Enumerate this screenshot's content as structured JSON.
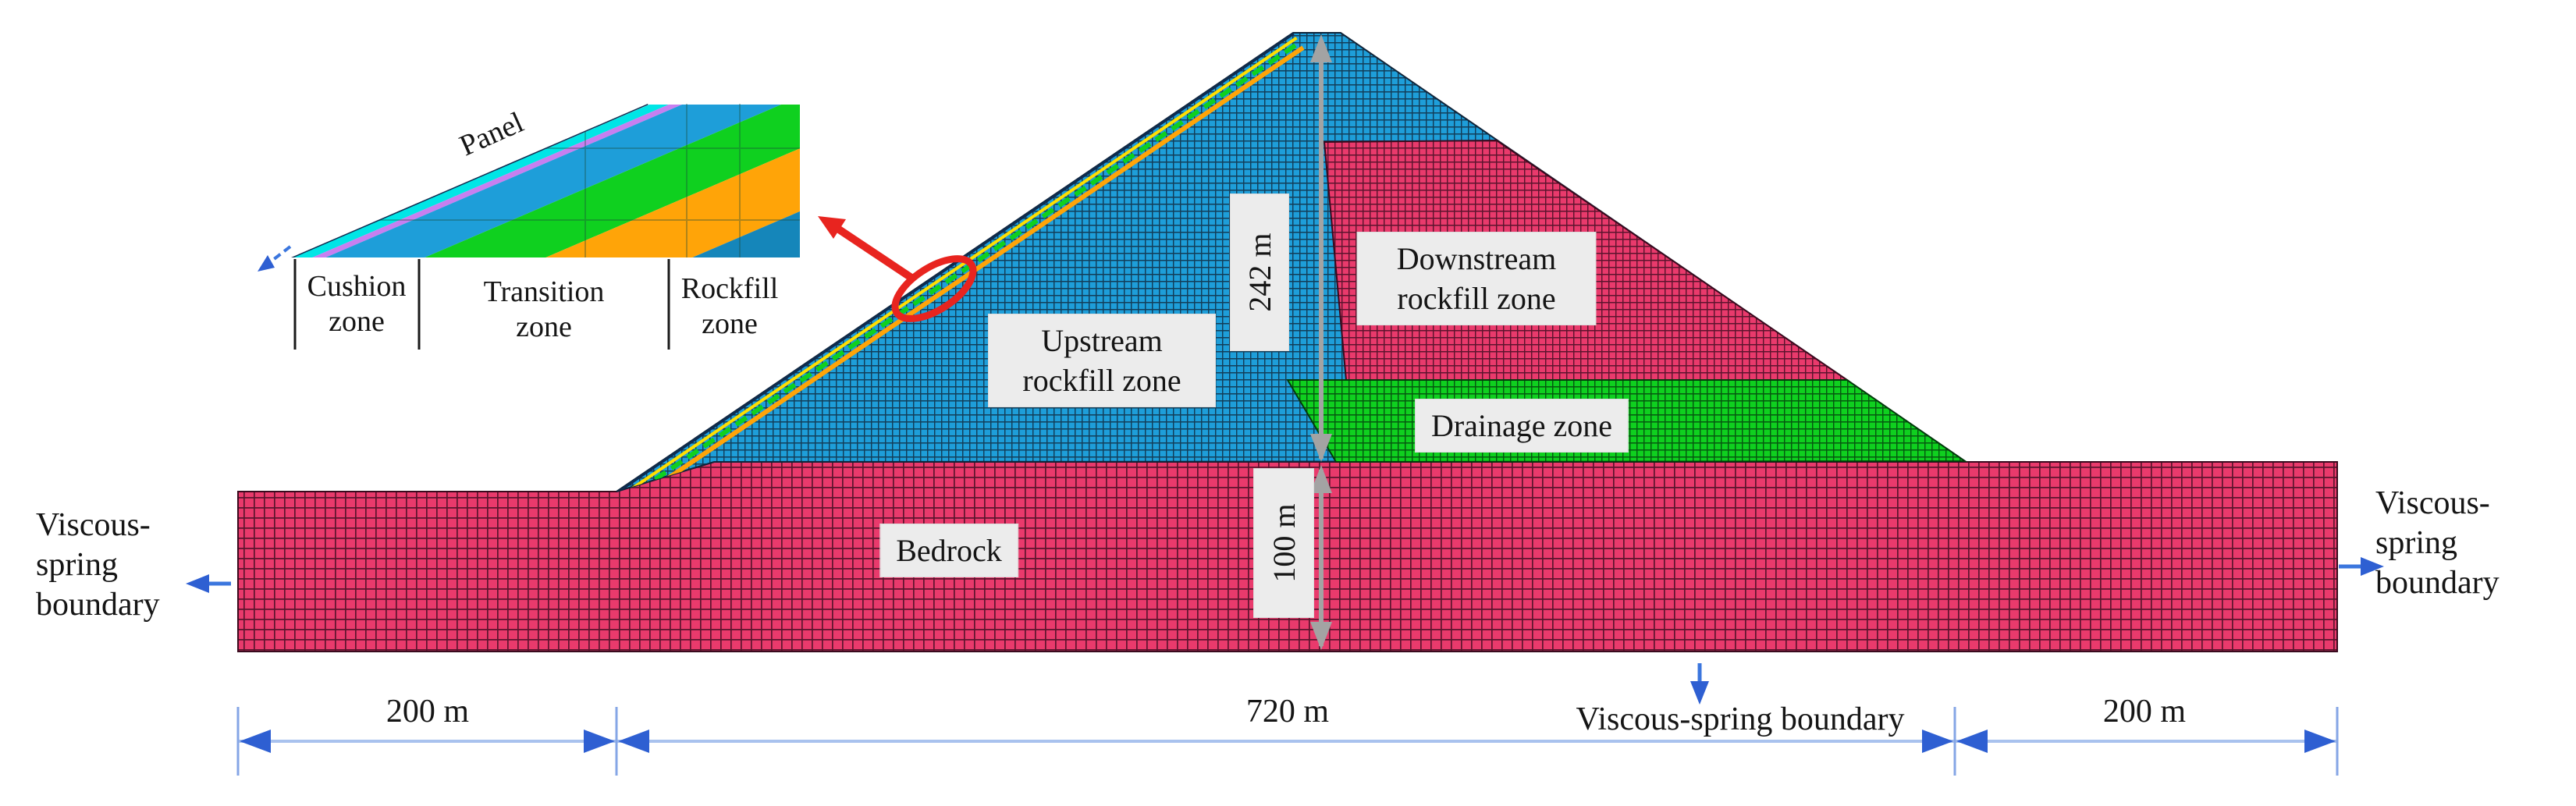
{
  "inset": {
    "panel_label": "Panel",
    "zone_labels": [
      "Cushion zone",
      "Transition zone",
      "Rockfill zone"
    ]
  },
  "dam": {
    "upstream_label": "Upstream rockfill zone",
    "downstream_label": "Downstream rockfill zone",
    "drainage_label": "Drainage zone",
    "bedrock_label": "Bedrock"
  },
  "dimensions": {
    "dam_height": "242 m",
    "foundation_depth": "100 m",
    "left_width": "200 m",
    "center_width": "720 m",
    "right_width": "200 m"
  },
  "boundaries": {
    "left": "Viscous-\nspring\nboundary",
    "right": "Viscous-\nspring\nboundary",
    "bottom": "Viscous-spring boundary"
  },
  "colors": {
    "upstream_blue": "#1E9ED9",
    "rockfill_crimson": "#E93A6C",
    "drainage_green": "#0FD01F",
    "panel_cyan": "#00E6E6",
    "cushion_violet": "#C77FF0",
    "transition_green": "#0FD01F",
    "zone_orange": "#FFA408",
    "rockfill_teal": "#1586BA",
    "label_box_gray": "#ECECEC",
    "dimension_gray": "#A3A3A3",
    "annotation_blue": "#3B76DE",
    "dim_line_blue": "#A9C2EE",
    "dim_arrow_blue": "#2E5FD2",
    "highlight_red": "#E8241F"
  }
}
